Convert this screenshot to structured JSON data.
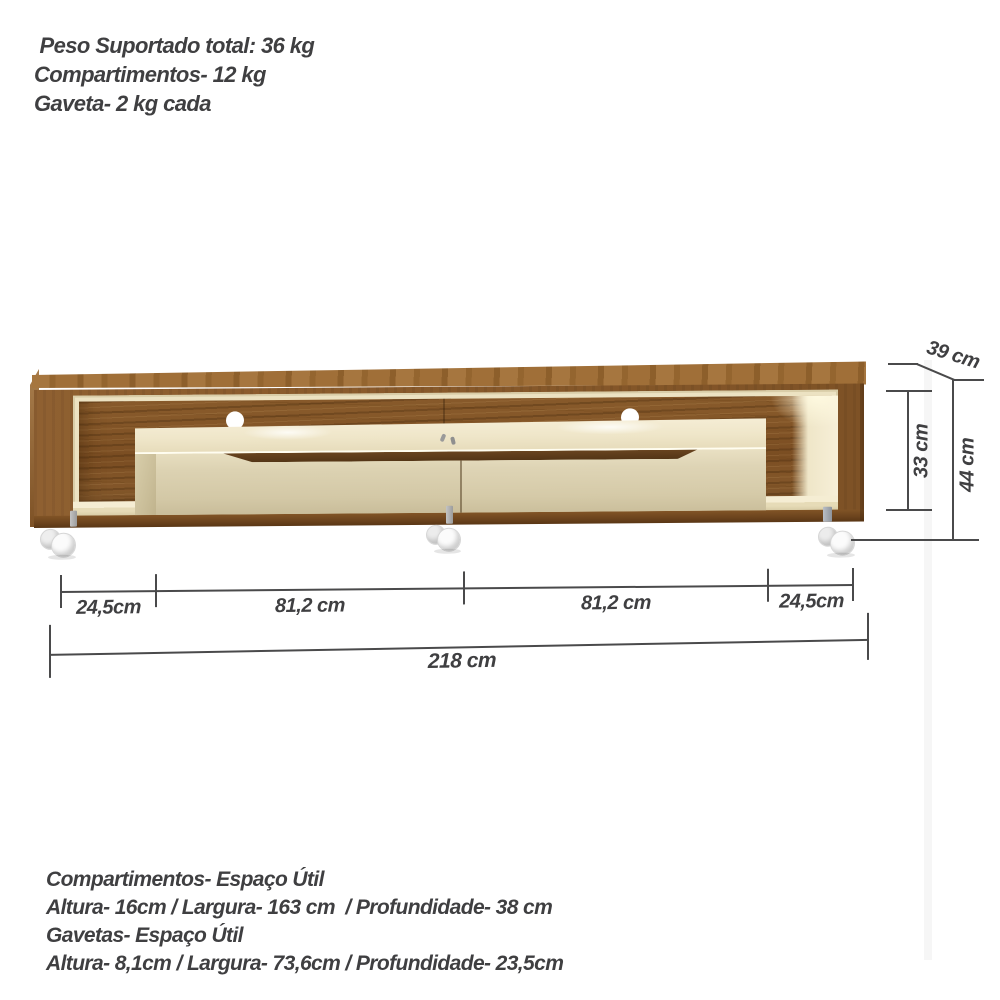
{
  "weight_info": {
    "line1": " Peso Suportado total: 36 kg",
    "line2": "Compartimentos- 12 kg",
    "line3": "Gaveta- 2 kg cada"
  },
  "dimensions": {
    "depth": "39 cm",
    "inner_height": "33 cm",
    "total_height": "44 cm",
    "segment_left_end": "24,5cm",
    "segment_left_drawer": "81,2 cm",
    "segment_right_drawer": "81,2 cm",
    "segment_right_end": "24,5cm",
    "total_width": "218 cm"
  },
  "usable_space_info": {
    "line1": "Compartimentos- Espaço Útil",
    "line2": "Altura- 16cm / Largura- 163 cm  / Profundidade- 38 cm",
    "line3": "Gavetas- Espaço Útil",
    "line4": "Altura- 8,1cm / Largura- 73,6cm / Profundidade- 23,5cm"
  },
  "colors": {
    "background": "#ffffff",
    "wood_frame": "#895a2b",
    "wood_panel_dark": "#7a4d22",
    "wood_top": "#9c6c38",
    "cream_interior": "#ece2c2",
    "drawer_front": "#d9ceac",
    "handle_groove": "#5c3a1b",
    "dimension_line": "#4a4a4b",
    "text": "#3f3f41"
  }
}
